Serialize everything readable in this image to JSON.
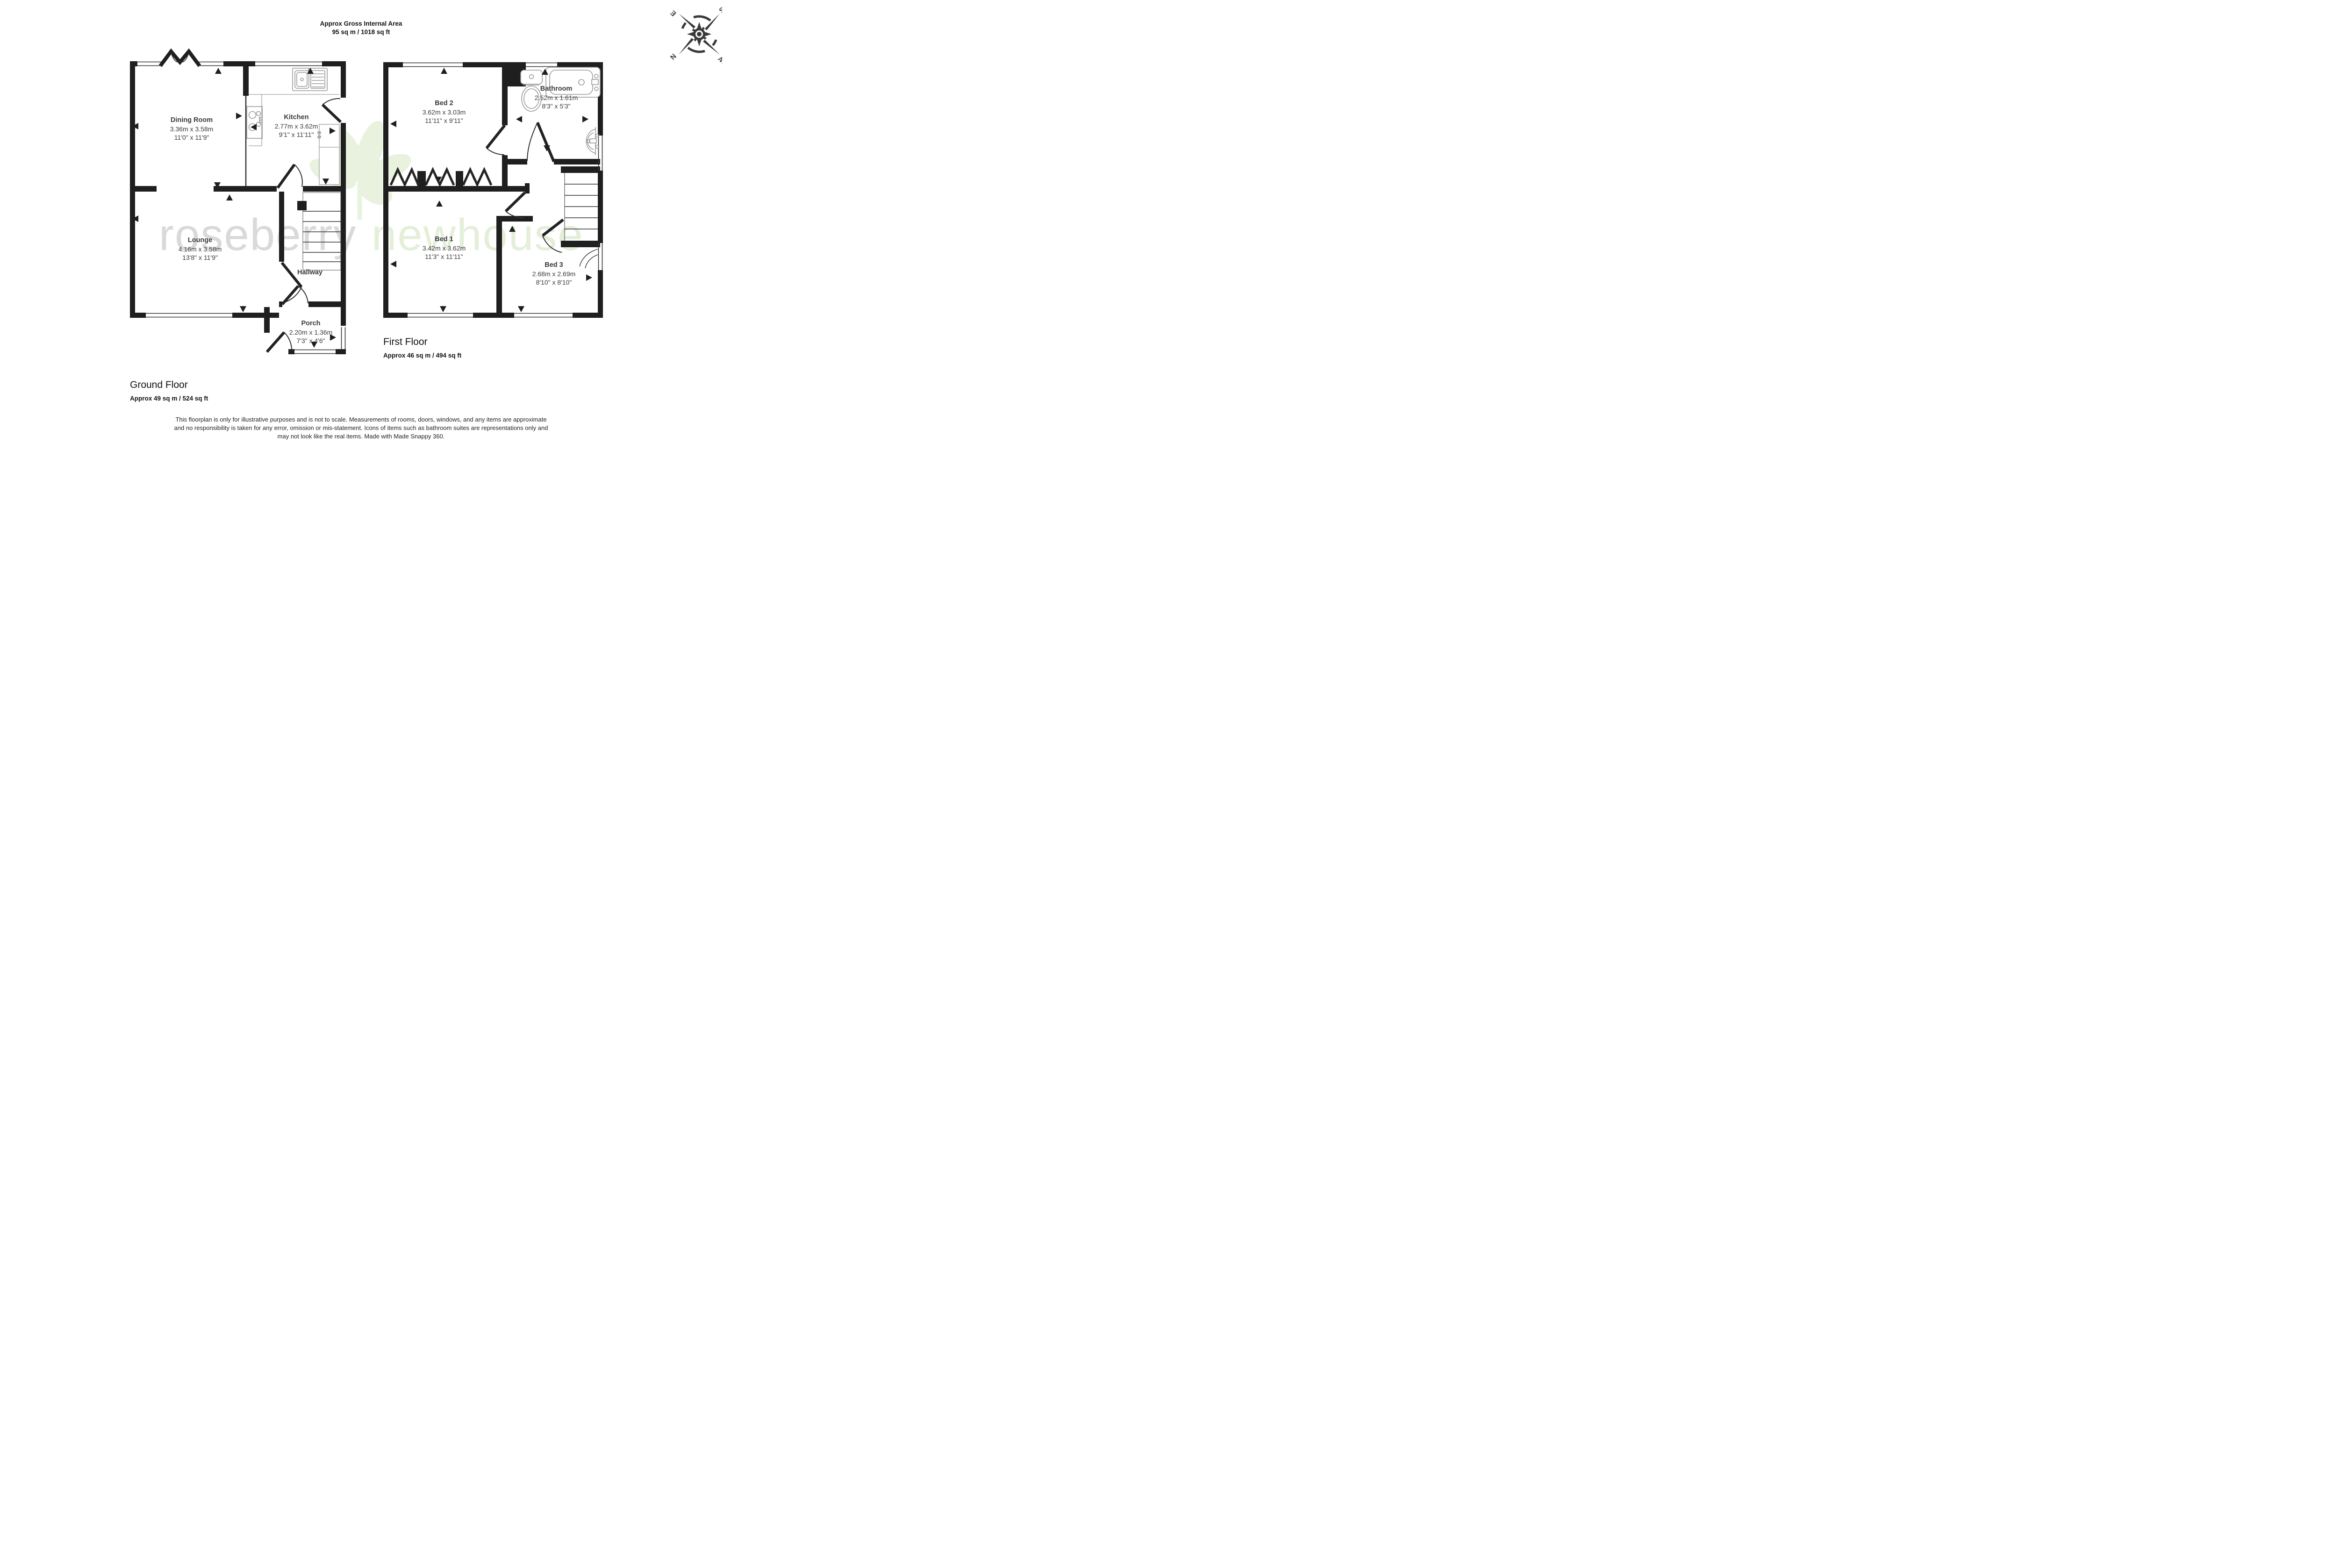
{
  "header": {
    "line1": "Approx Gross Internal Area",
    "line2": "95 sq m / 1018 sq ft"
  },
  "compass": {
    "n": "N",
    "e": "E",
    "s": "S",
    "w": "W"
  },
  "watermark": {
    "word1": "roseberry",
    "word2": "newhouse"
  },
  "colors": {
    "wall": "#1f1f1f",
    "fixture": "#9a9a9a",
    "text": "#3a3a3a",
    "watermark_gray": "#d9d9d9",
    "watermark_green": "#e4efd9"
  },
  "ground_floor": {
    "title": "Ground Floor",
    "area": "Approx 49 sq m / 524 sq ft",
    "rooms": {
      "dining": {
        "name": "Dining Room",
        "metric": "3.36m x 3.58m",
        "imperial": "11'0\" x 11'9\""
      },
      "kitchen": {
        "name": "Kitchen",
        "metric": "2.77m x 3.62m",
        "imperial": "9'1\" x 11'11\""
      },
      "lounge": {
        "name": "Lounge",
        "metric": "4.16m x 3.58m",
        "imperial": "13'8\" x 11'9\""
      },
      "hallway": {
        "name": "Hallway"
      },
      "porch": {
        "name": "Porch",
        "metric": "2.20m x 1.36m",
        "imperial": "7'3\" x 4'6\""
      }
    }
  },
  "first_floor": {
    "title": "First Floor",
    "area": "Approx 46 sq m / 494 sq ft",
    "rooms": {
      "bed2": {
        "name": "Bed 2",
        "metric": "3.62m x 3.03m",
        "imperial": "11'11\" x 9'11\""
      },
      "bathroom": {
        "name": "Bathroom",
        "metric": "2.52m x 1.61m",
        "imperial": "8'3\" x 5'3\""
      },
      "bed1": {
        "name": "Bed 1",
        "metric": "3.42m x 3.62m",
        "imperial": "11'3\" x 11'11\""
      },
      "bed3": {
        "name": "Bed 3",
        "metric": "2.68m x 2.69m",
        "imperial": "8'10\" x 8'10\""
      }
    }
  },
  "disclaimer": [
    "This floorplan is only for illustrative purposes and is not to scale. Measurements of rooms, doors, windows, and any items are approximate",
    "and no responsibility is taken for any error, omission or mis-statement. Icons of items such as bathroom suites are representations only and",
    "may not look like the real items. Made with Made Snappy 360."
  ]
}
